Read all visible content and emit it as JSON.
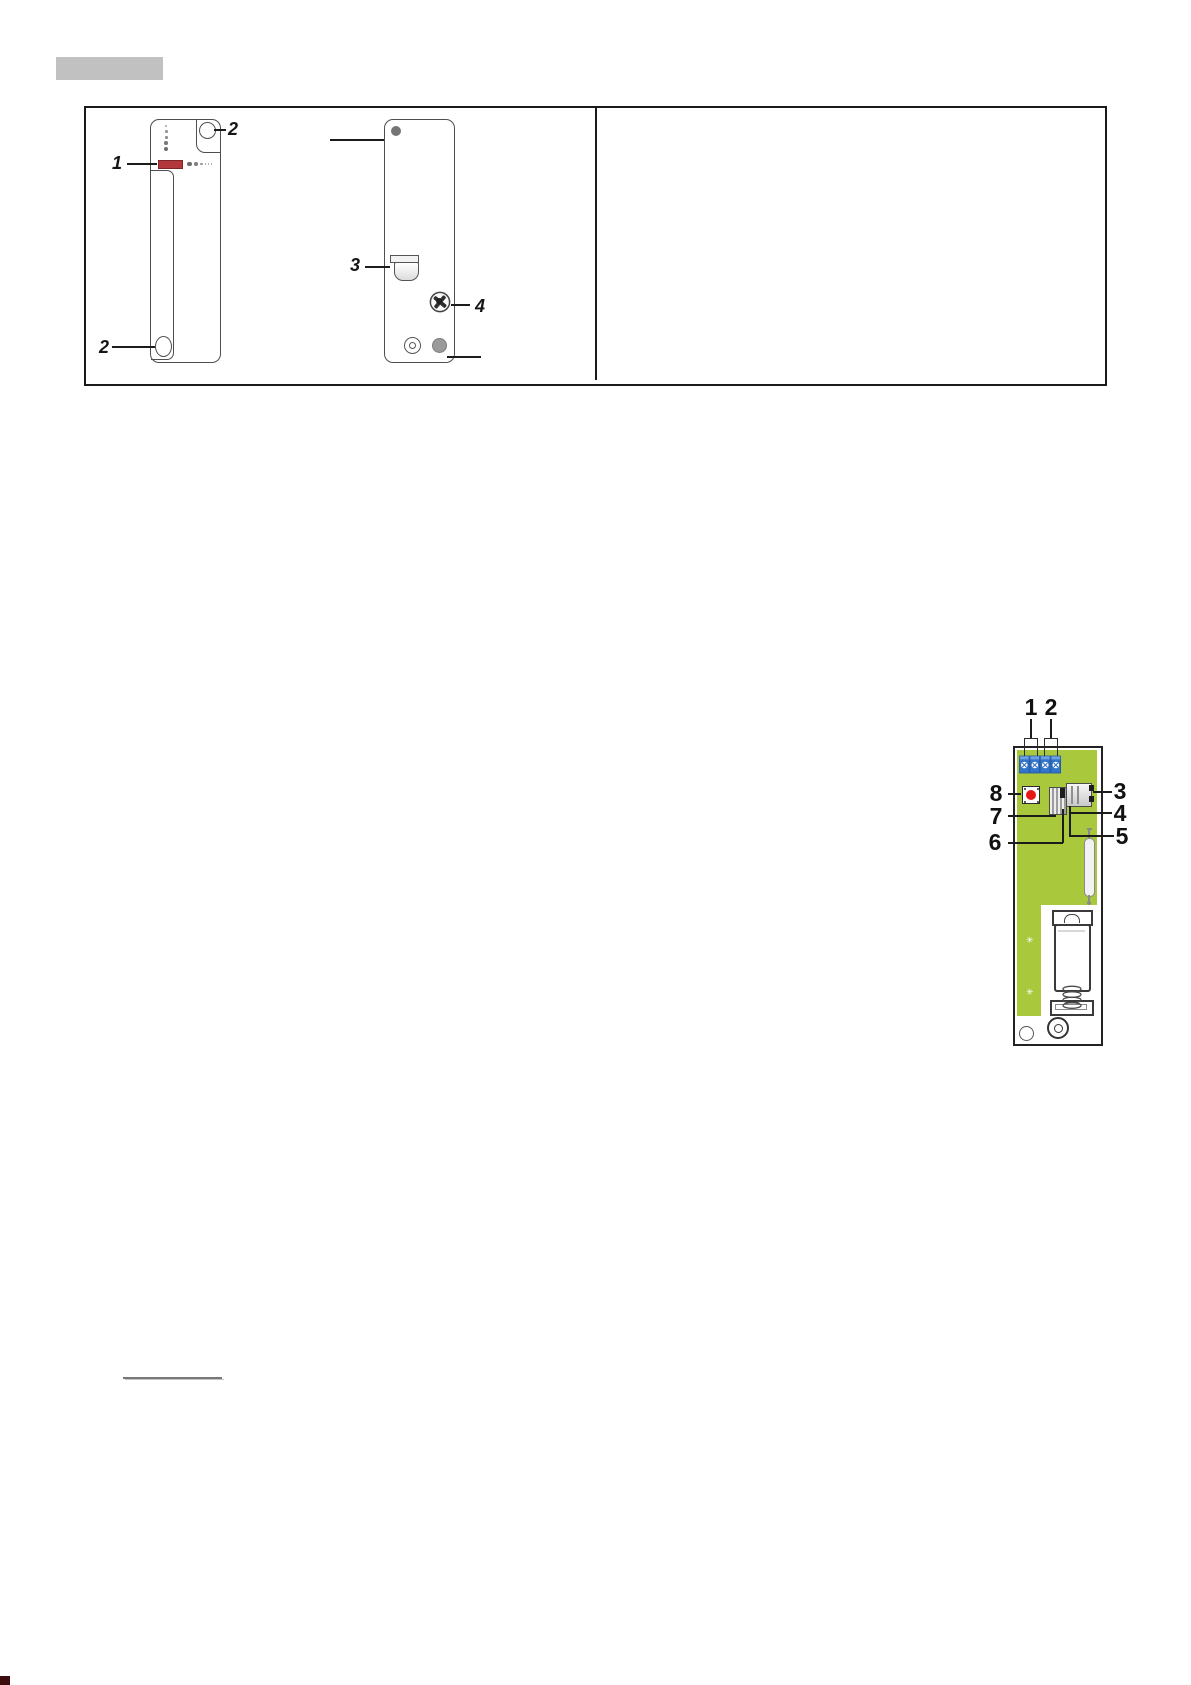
{
  "figure_panel": {
    "front_view": {
      "callout_led": "1",
      "callout_button_top": "2",
      "callout_button_bottom": "2"
    },
    "back_view": {
      "callout_connector": "3",
      "callout_screw": "4"
    }
  },
  "pcb_panel": {
    "callout_1": "1",
    "callout_2": "2",
    "callout_3": "3",
    "callout_4": "4",
    "callout_5": "5",
    "callout_6": "6",
    "callout_7": "7",
    "callout_8": "8"
  },
  "icons": {
    "screw_mark": "✳"
  },
  "colors": {
    "heading_bar_gray": "#c1c1c1",
    "pcb_green": "#a9c83b",
    "terminal_blue": "#3274cc",
    "button_red": "#e81717",
    "led_red": "#b3383c",
    "underline_gray": "#787878",
    "corner_mark": "#3d0c0e"
  }
}
